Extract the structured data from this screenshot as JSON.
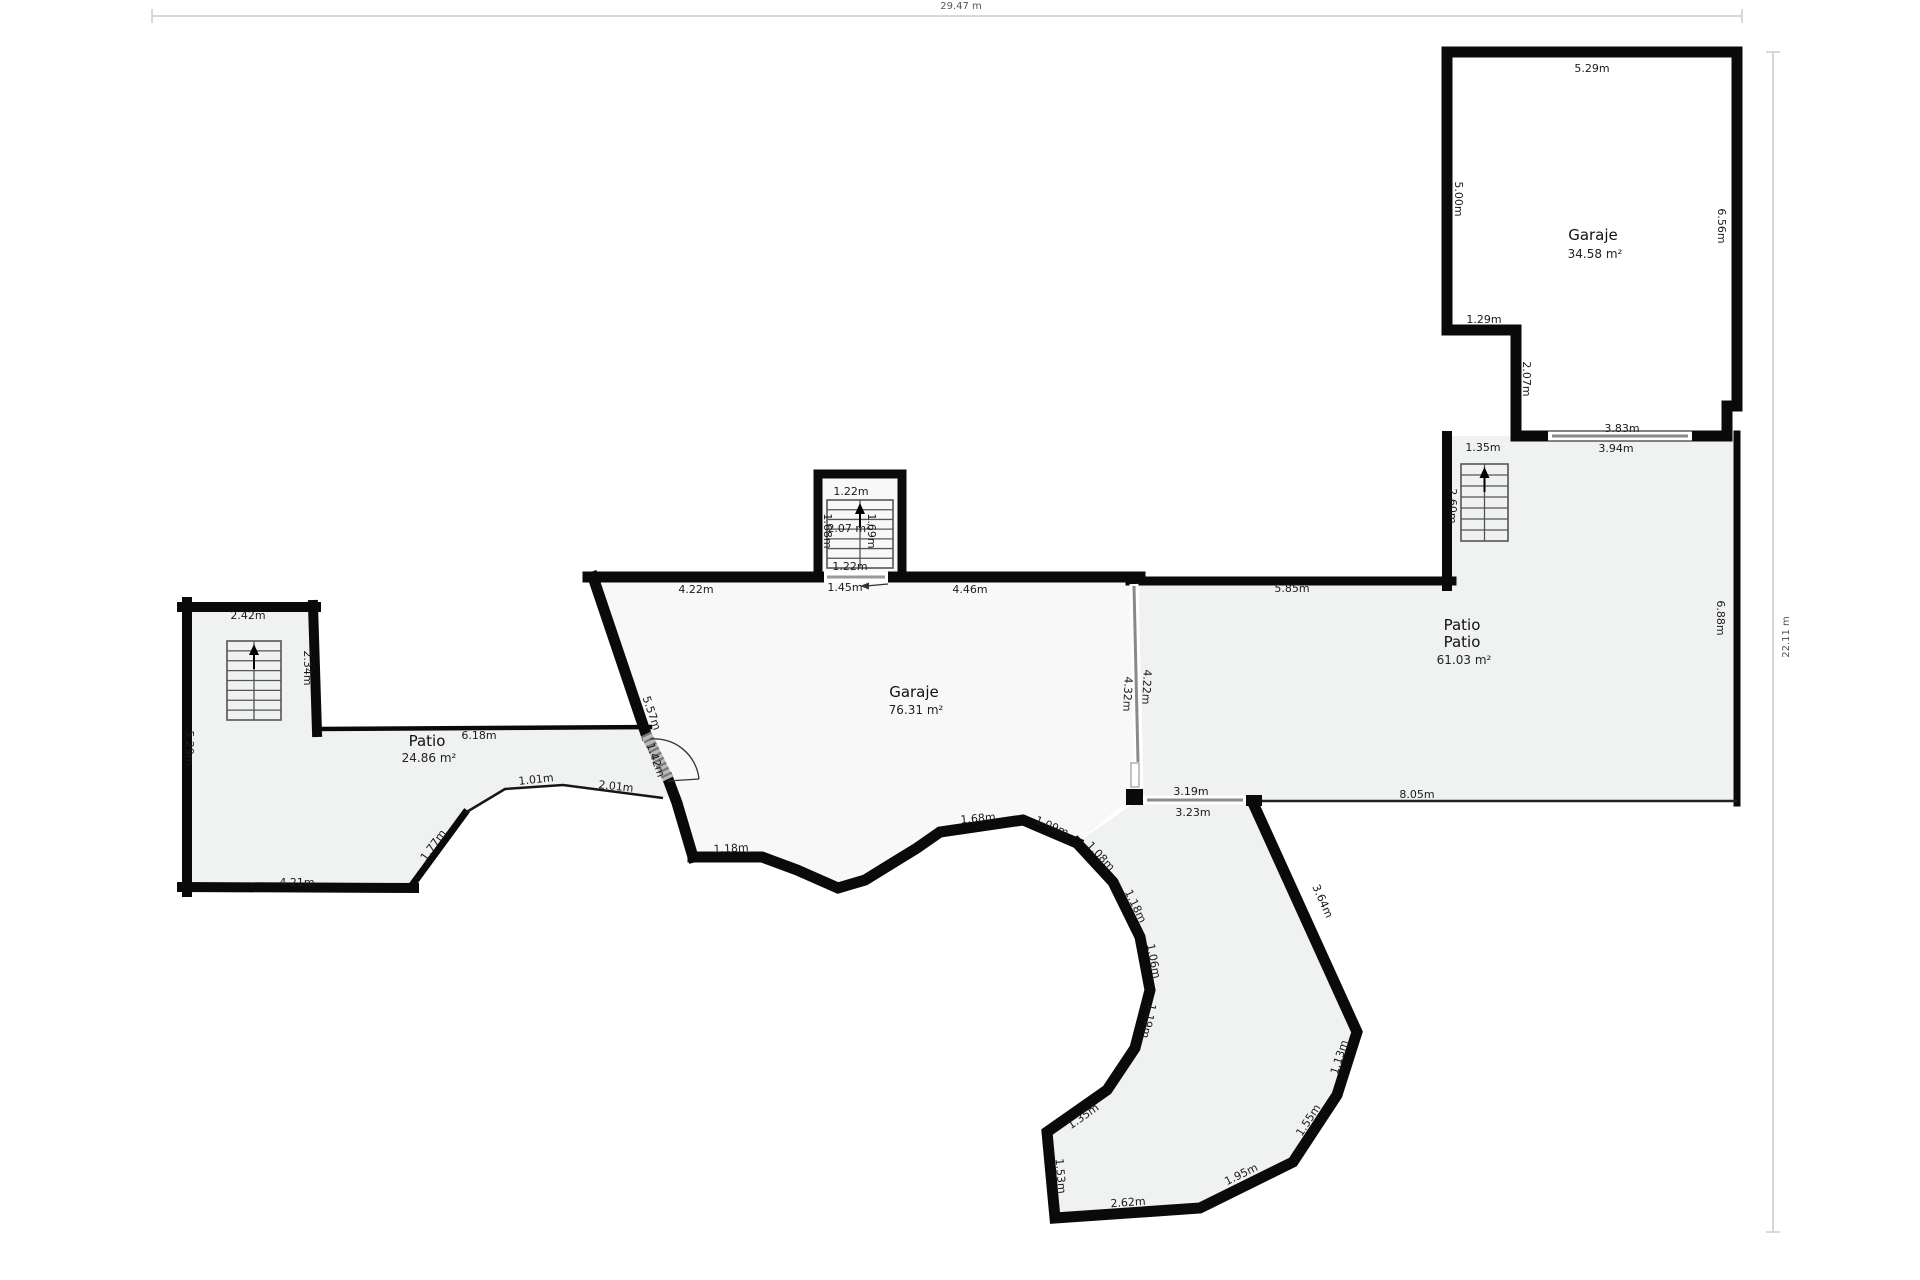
{
  "rulers": {
    "top": {
      "label": "29.47 m"
    },
    "right": {
      "label": "22.11 m"
    }
  },
  "rooms": {
    "garaje_tr": {
      "name": "Garaje",
      "area": "34.58 m²"
    },
    "patio_right": {
      "name": "Patio",
      "subname": "Patio",
      "area": "61.03 m²"
    },
    "garaje_mid": {
      "name": "Garaje",
      "area": "76.31 m²"
    },
    "patio_left": {
      "name": "Patio",
      "area": "24.86 m²"
    }
  },
  "dimensions": [
    {
      "text": "5.29m",
      "x": 1592,
      "y": 68,
      "rot": 0
    },
    {
      "text": "5.00m",
      "x": 1459,
      "y": 199,
      "rot": 90
    },
    {
      "text": "6.56m",
      "x": 1722,
      "y": 226,
      "rot": 90
    },
    {
      "text": "1.29m",
      "x": 1484,
      "y": 319,
      "rot": 0
    },
    {
      "text": "2.07m",
      "x": 1527,
      "y": 379,
      "rot": 90
    },
    {
      "text": "3.83m",
      "x": 1622,
      "y": 428,
      "rot": 0
    },
    {
      "text": "3.94m",
      "x": 1616,
      "y": 448,
      "rot": 0
    },
    {
      "text": "1.35m",
      "x": 1483,
      "y": 447,
      "rot": 0
    },
    {
      "text": "2.60m",
      "x": 1453,
      "y": 506,
      "rot": 90
    },
    {
      "text": "5.85m",
      "x": 1292,
      "y": 588,
      "rot": 0
    },
    {
      "text": "6.88m",
      "x": 1721,
      "y": 618,
      "rot": 90
    },
    {
      "text": "4.22m",
      "x": 1147,
      "y": 687,
      "rot": 93
    },
    {
      "text": "4.32m",
      "x": 1128,
      "y": 694,
      "rot": 93
    },
    {
      "text": "3.19m",
      "x": 1191,
      "y": 791,
      "rot": 0
    },
    {
      "text": "3.23m",
      "x": 1193,
      "y": 812,
      "rot": 0
    },
    {
      "text": "8.05m",
      "x": 1417,
      "y": 794,
      "rot": 0
    },
    {
      "text": "4.22m",
      "x": 696,
      "y": 589,
      "rot": 0
    },
    {
      "text": "1.45m",
      "x": 845,
      "y": 587,
      "rot": 0
    },
    {
      "text": "4.46m",
      "x": 970,
      "y": 589,
      "rot": 0
    },
    {
      "text": "1.22m",
      "x": 851,
      "y": 491,
      "rot": 0
    },
    {
      "text": "2.07 m²",
      "x": 849,
      "y": 528,
      "rot": 0
    },
    {
      "text": "1.68m",
      "x": 828,
      "y": 531,
      "rot": 90
    },
    {
      "text": "1.69m",
      "x": 872,
      "y": 531,
      "rot": 90
    },
    {
      "text": "1.22m",
      "x": 850,
      "y": 566,
      "rot": 0
    },
    {
      "text": "5.57m",
      "x": 652,
      "y": 713,
      "rot": 71
    },
    {
      "text": "1.42m",
      "x": 656,
      "y": 760,
      "rot": 71
    },
    {
      "text": "1.18m",
      "x": 731,
      "y": 848,
      "rot": -3
    },
    {
      "text": "2.42m",
      "x": 248,
      "y": 615,
      "rot": 0
    },
    {
      "text": "2.34m",
      "x": 308,
      "y": 668,
      "rot": 90
    },
    {
      "text": "5.29m",
      "x": 190,
      "y": 748,
      "rot": 90
    },
    {
      "text": "6.18m",
      "x": 479,
      "y": 735,
      "rot": 0
    },
    {
      "text": "1.01m",
      "x": 536,
      "y": 779,
      "rot": -6
    },
    {
      "text": "2.01m",
      "x": 616,
      "y": 786,
      "rot": 6
    },
    {
      "text": "1.77m",
      "x": 433,
      "y": 845,
      "rot": -54
    },
    {
      "text": "4.21m",
      "x": 297,
      "y": 882,
      "rot": 0
    },
    {
      "text": "1.68m",
      "x": 978,
      "y": 818,
      "rot": -5
    },
    {
      "text": "1.09m",
      "x": 1052,
      "y": 826,
      "rot": 23
    },
    {
      "text": "1.08m",
      "x": 1101,
      "y": 856,
      "rot": 47
    },
    {
      "text": "1.18m",
      "x": 1136,
      "y": 906,
      "rot": 64
    },
    {
      "text": "1.06m",
      "x": 1154,
      "y": 961,
      "rot": 79
    },
    {
      "text": "1.19m",
      "x": 1149,
      "y": 1021,
      "rot": 102
    },
    {
      "text": "1.35m",
      "x": 1083,
      "y": 1116,
      "rot": -35
    },
    {
      "text": "1.53m",
      "x": 1061,
      "y": 1176,
      "rot": 85
    },
    {
      "text": "2.62m",
      "x": 1128,
      "y": 1202,
      "rot": -4
    },
    {
      "text": "1.95m",
      "x": 1241,
      "y": 1174,
      "rot": -26
    },
    {
      "text": "1.55m",
      "x": 1308,
      "y": 1120,
      "rot": -57
    },
    {
      "text": "1.13m",
      "x": 1339,
      "y": 1057,
      "rot": -72
    },
    {
      "text": "3.64m",
      "x": 1323,
      "y": 901,
      "rot": 66
    }
  ]
}
